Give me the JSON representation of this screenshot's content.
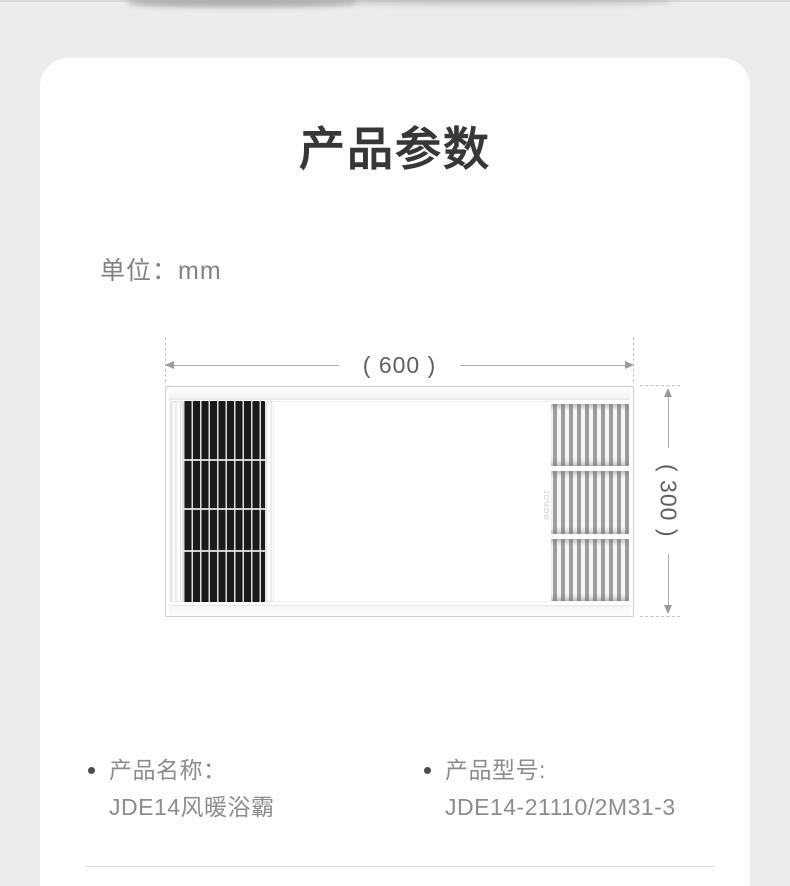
{
  "page": {
    "title": "产品参数",
    "unit_label": "单位：mm"
  },
  "diagram": {
    "width_label": "( 600 )",
    "height_label": "( 300 )",
    "logo": "JOMOO"
  },
  "specs": [
    {
      "label": "产品名称：",
      "value": "JDE14风暖浴霸"
    },
    {
      "label": "产品型号:",
      "value": "JDE14-21110/2M31-3"
    }
  ],
  "icons": {
    "bullet": "dot",
    "arrow_left": "◄",
    "arrow_right": "►",
    "arrow_up": "▲",
    "arrow_down": "▼"
  },
  "colors": {
    "page_bg": "#ececec",
    "card_bg": "#ffffff",
    "title_text": "#373737",
    "secondary_text": "#8c8c8c",
    "dimension_line": "#ababab",
    "grille_dark": "#1a1a1a"
  }
}
